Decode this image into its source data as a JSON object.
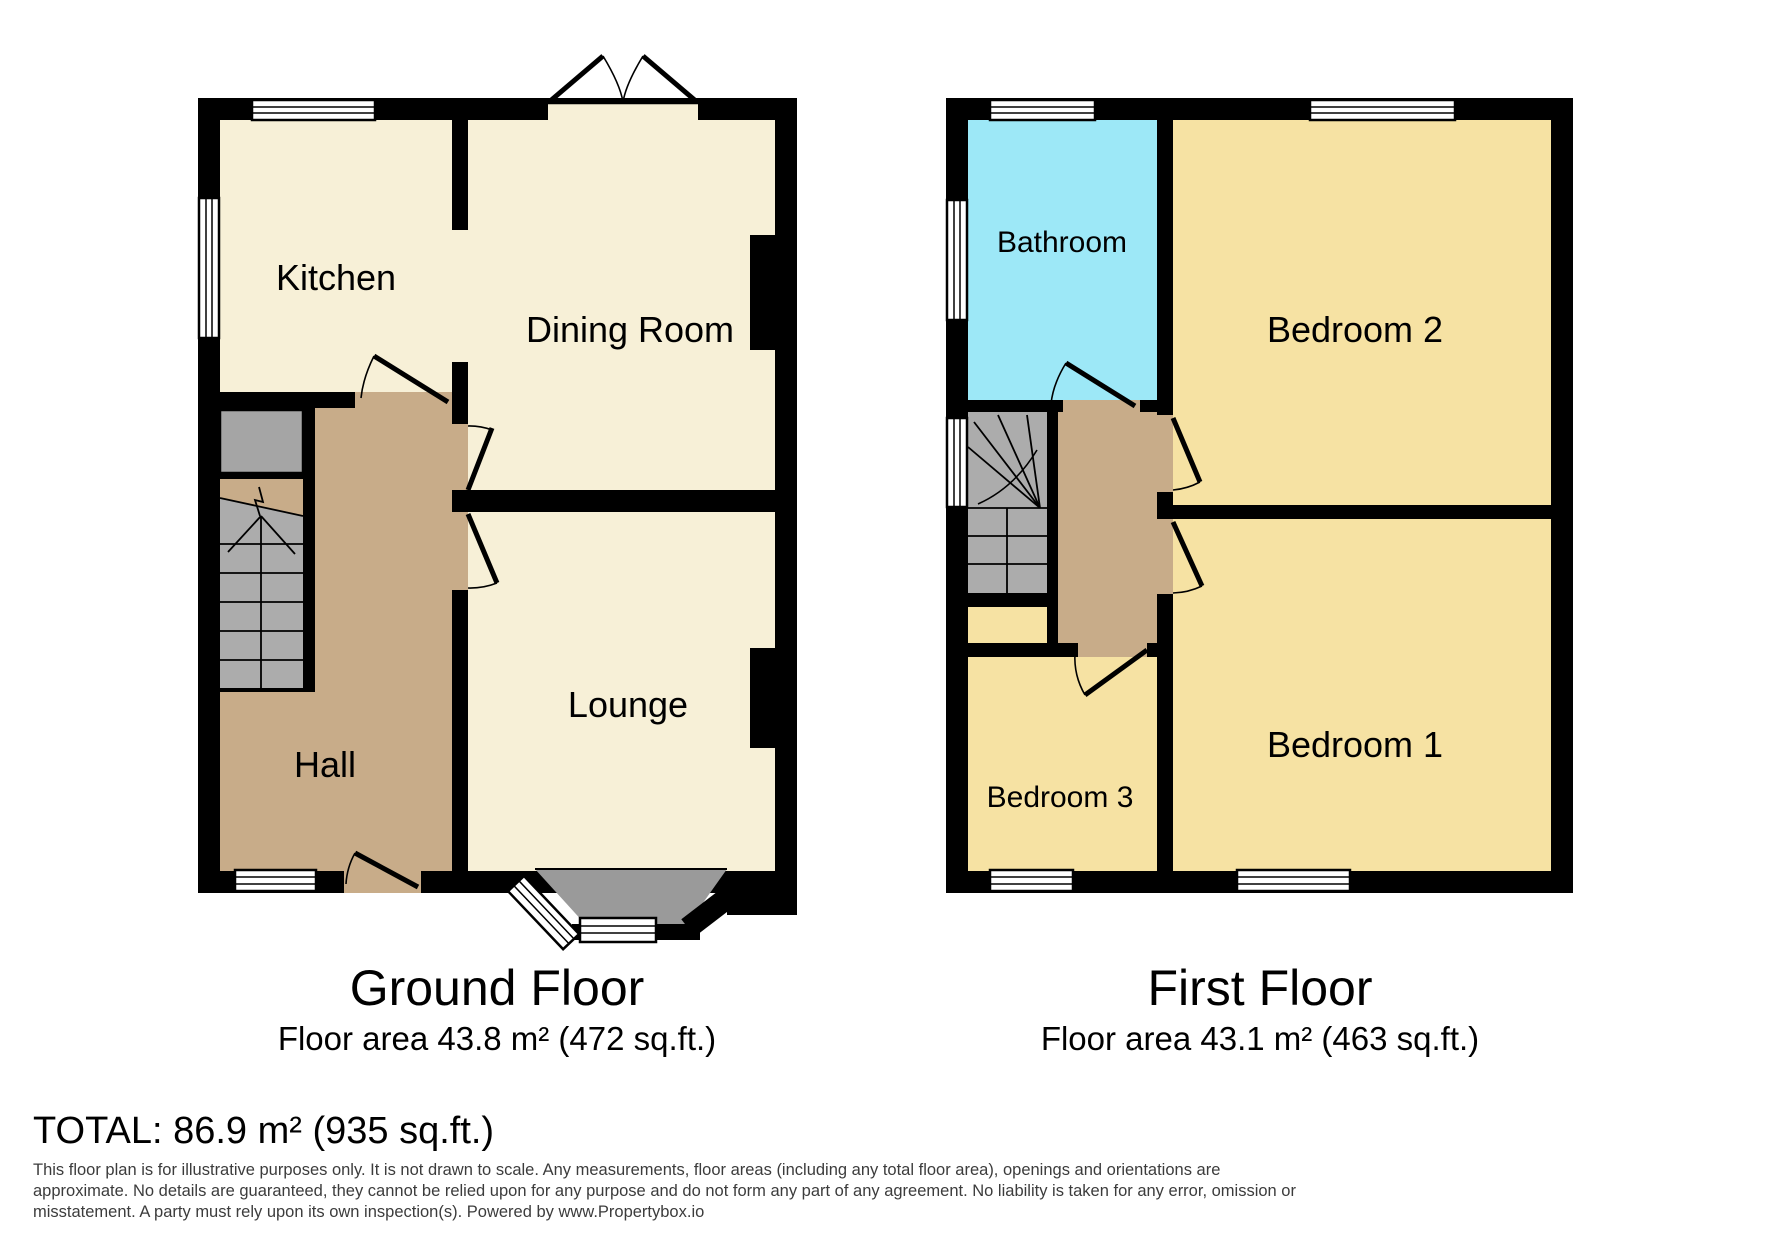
{
  "floors": [
    {
      "name": "Ground Floor",
      "area_label": "Floor area 43.8 m² (472 sq.ft.)",
      "rooms": [
        {
          "label": "Kitchen"
        },
        {
          "label": "Dining Room"
        },
        {
          "label": "Lounge"
        },
        {
          "label": "Hall"
        }
      ]
    },
    {
      "name": "First Floor",
      "area_label": "Floor area 43.1 m² (463 sq.ft.)",
      "rooms": [
        {
          "label": "Bathroom"
        },
        {
          "label": "Bedroom 2"
        },
        {
          "label": "Bedroom 1"
        },
        {
          "label": "Bedroom 3"
        }
      ]
    }
  ],
  "footer": {
    "total_label": "TOTAL: 86.9 m² (935 sq.ft.)",
    "disclaimer_lines": [
      "This floor plan is for illustrative purposes only. It is not drawn to scale. Any measurements, floor areas (including any total floor area), openings and orientations are",
      "approximate. No details are guaranteed, they cannot be relied upon for any purpose and do not form any part of any agreement. No liability is taken for any error, omission or",
      "misstatement. A party must rely upon its own inspection(s). Powered by www.Propertybox.io"
    ]
  },
  "colors": {
    "wall": "#000000",
    "ground_room_fill": "#F7F0D7",
    "hall_fill": "#C8AC89",
    "bedroom_fill": "#F6E2A3",
    "bathroom_fill": "#9DE8F7",
    "stairs_gray": "#ACACAC",
    "bay_gray": "#9A9A9A",
    "storage_gray": "#A5A5A5"
  }
}
